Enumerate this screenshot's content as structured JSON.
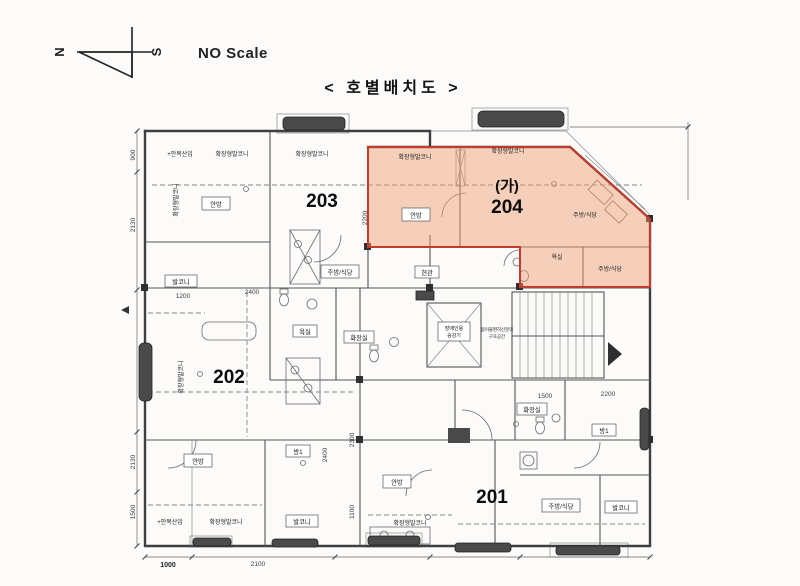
{
  "header": {
    "scale_note": "NO Scale",
    "title": "< 호별배치도 >"
  },
  "compass": {
    "north": "N",
    "south": "S"
  },
  "units": {
    "u201": "201",
    "u202": "202",
    "u203": "203",
    "u204": "204",
    "u204_mark": "(가)"
  },
  "labels": {
    "master_bedroom": "안방",
    "room1": "방1",
    "balcony": "발코니",
    "ext_balcony": "확장형발코니",
    "eaves_note": "+안목산입",
    "kitchen_dining": "주방/식당",
    "bath": "욕실",
    "toilet": "화장실",
    "entrance": "현관",
    "elevator_line1": "장애인용",
    "elevator_line2": "승강기",
    "refuge_line1": "몸이불편하신분의",
    "refuge_line2": "구호공간"
  },
  "dimensions": {
    "d900": "900",
    "d2130": "2130",
    "d1500": "1500",
    "d1000": "1000",
    "d2100": "2100",
    "d1200": "1200",
    "d2400": "2400",
    "d2300": "2300",
    "d2200": "2200",
    "d1100": "1100"
  },
  "highlight": {
    "fill": "#ef9e74",
    "border": "#c23b2c"
  }
}
